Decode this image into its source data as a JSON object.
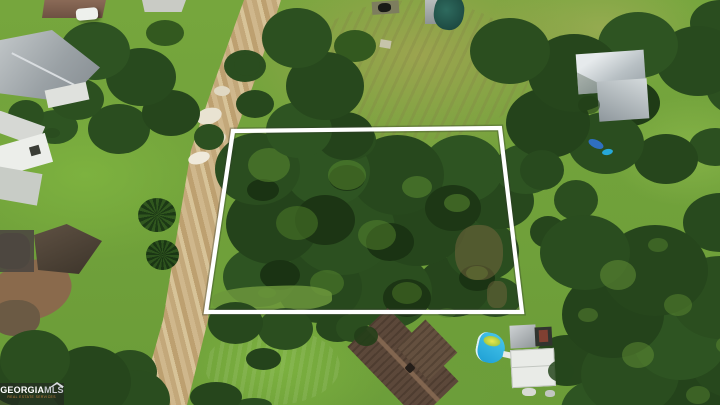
{
  "image": {
    "alt": "Aerial drone view of a wooded vacant residential lot outlined in white, beside a tan dirt road, green lawns, neighboring houses, sheds and a small blue pool"
  },
  "watermark": {
    "brand_primary": "GEORGIA",
    "brand_secondary": "MLS",
    "tagline": "REAL ESTATE SERVICES"
  },
  "overlay": {
    "boundary_points": "233,131 500,128 522,312 206,312",
    "boundary_color": "#ffffff"
  },
  "palette": {
    "lawn_green": "#74a43c",
    "field_olive": "#9aa455",
    "canopy_dark": "#27481d",
    "canopy_light": "#54862e",
    "dirt_road_tan": "#c9ae80",
    "roof_gray": "#aab2b6",
    "roof_brown": "#5c483a",
    "pool_blue": "#27b2e2",
    "pond_teal": "#245a50",
    "watermark_bar": "rgba(35,35,35,0.55)"
  }
}
